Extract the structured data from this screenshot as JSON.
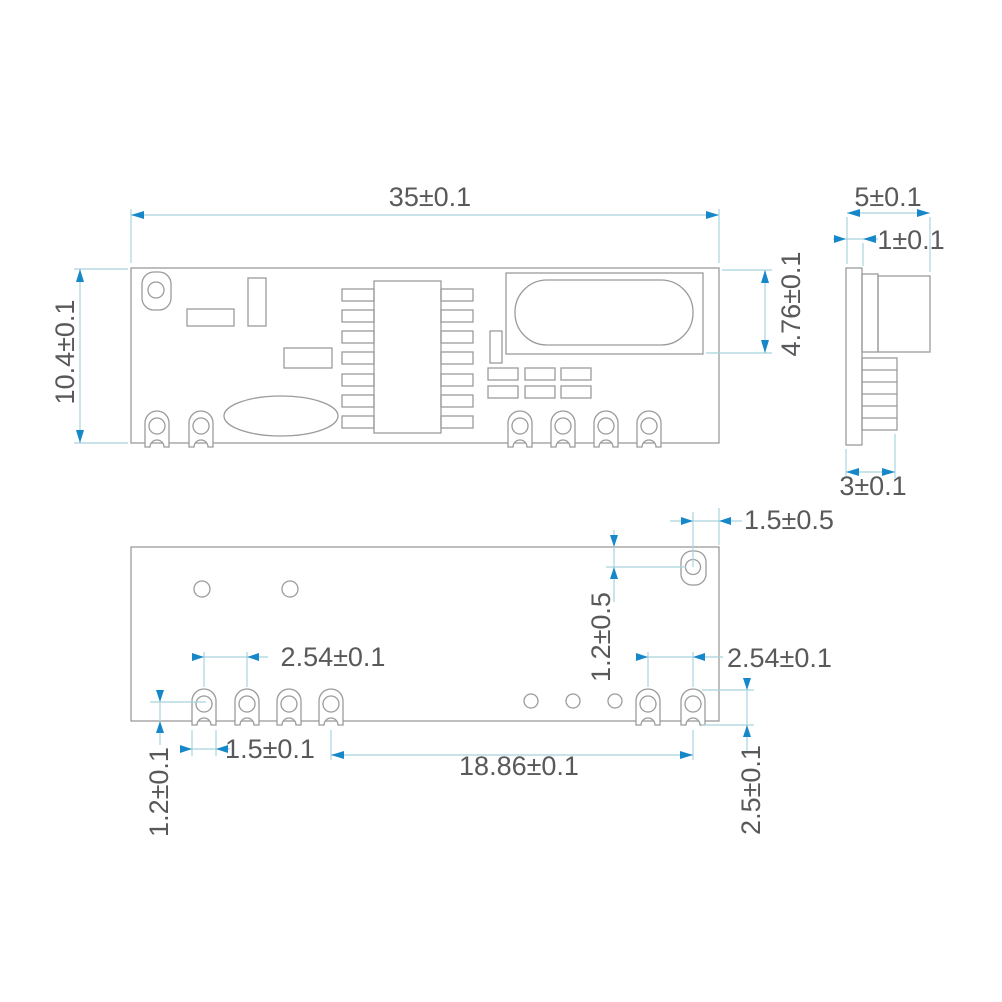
{
  "colors": {
    "outline": "#9b9b9b",
    "dimension_line": "#a6d4de",
    "arrow": "#1687c8",
    "text": "#58595b",
    "background": "#ffffff"
  },
  "views": {
    "top_view": {
      "dimensions": {
        "width": "35±0.1",
        "height": "10.4±0.1",
        "shield_height": "4.76±0.1"
      }
    },
    "side_view": {
      "dimensions": {
        "total_width": "5±0.1",
        "pcb_thickness": "1±0.1",
        "pin_row_depth": "3±0.1"
      }
    },
    "bottom_view": {
      "dimensions": {
        "hole_to_edge": "1.5±0.5",
        "hole_to_top": "1.2±0.5",
        "left_pin_pitch": "2.54±0.1",
        "right_pin_pitch": "2.54±0.1",
        "pad_width": "1.5±0.1",
        "pin_group_span": "18.86±0.1",
        "pad_to_edge": "1.2±0.1",
        "pad_length": "2.5±0.1"
      }
    }
  }
}
